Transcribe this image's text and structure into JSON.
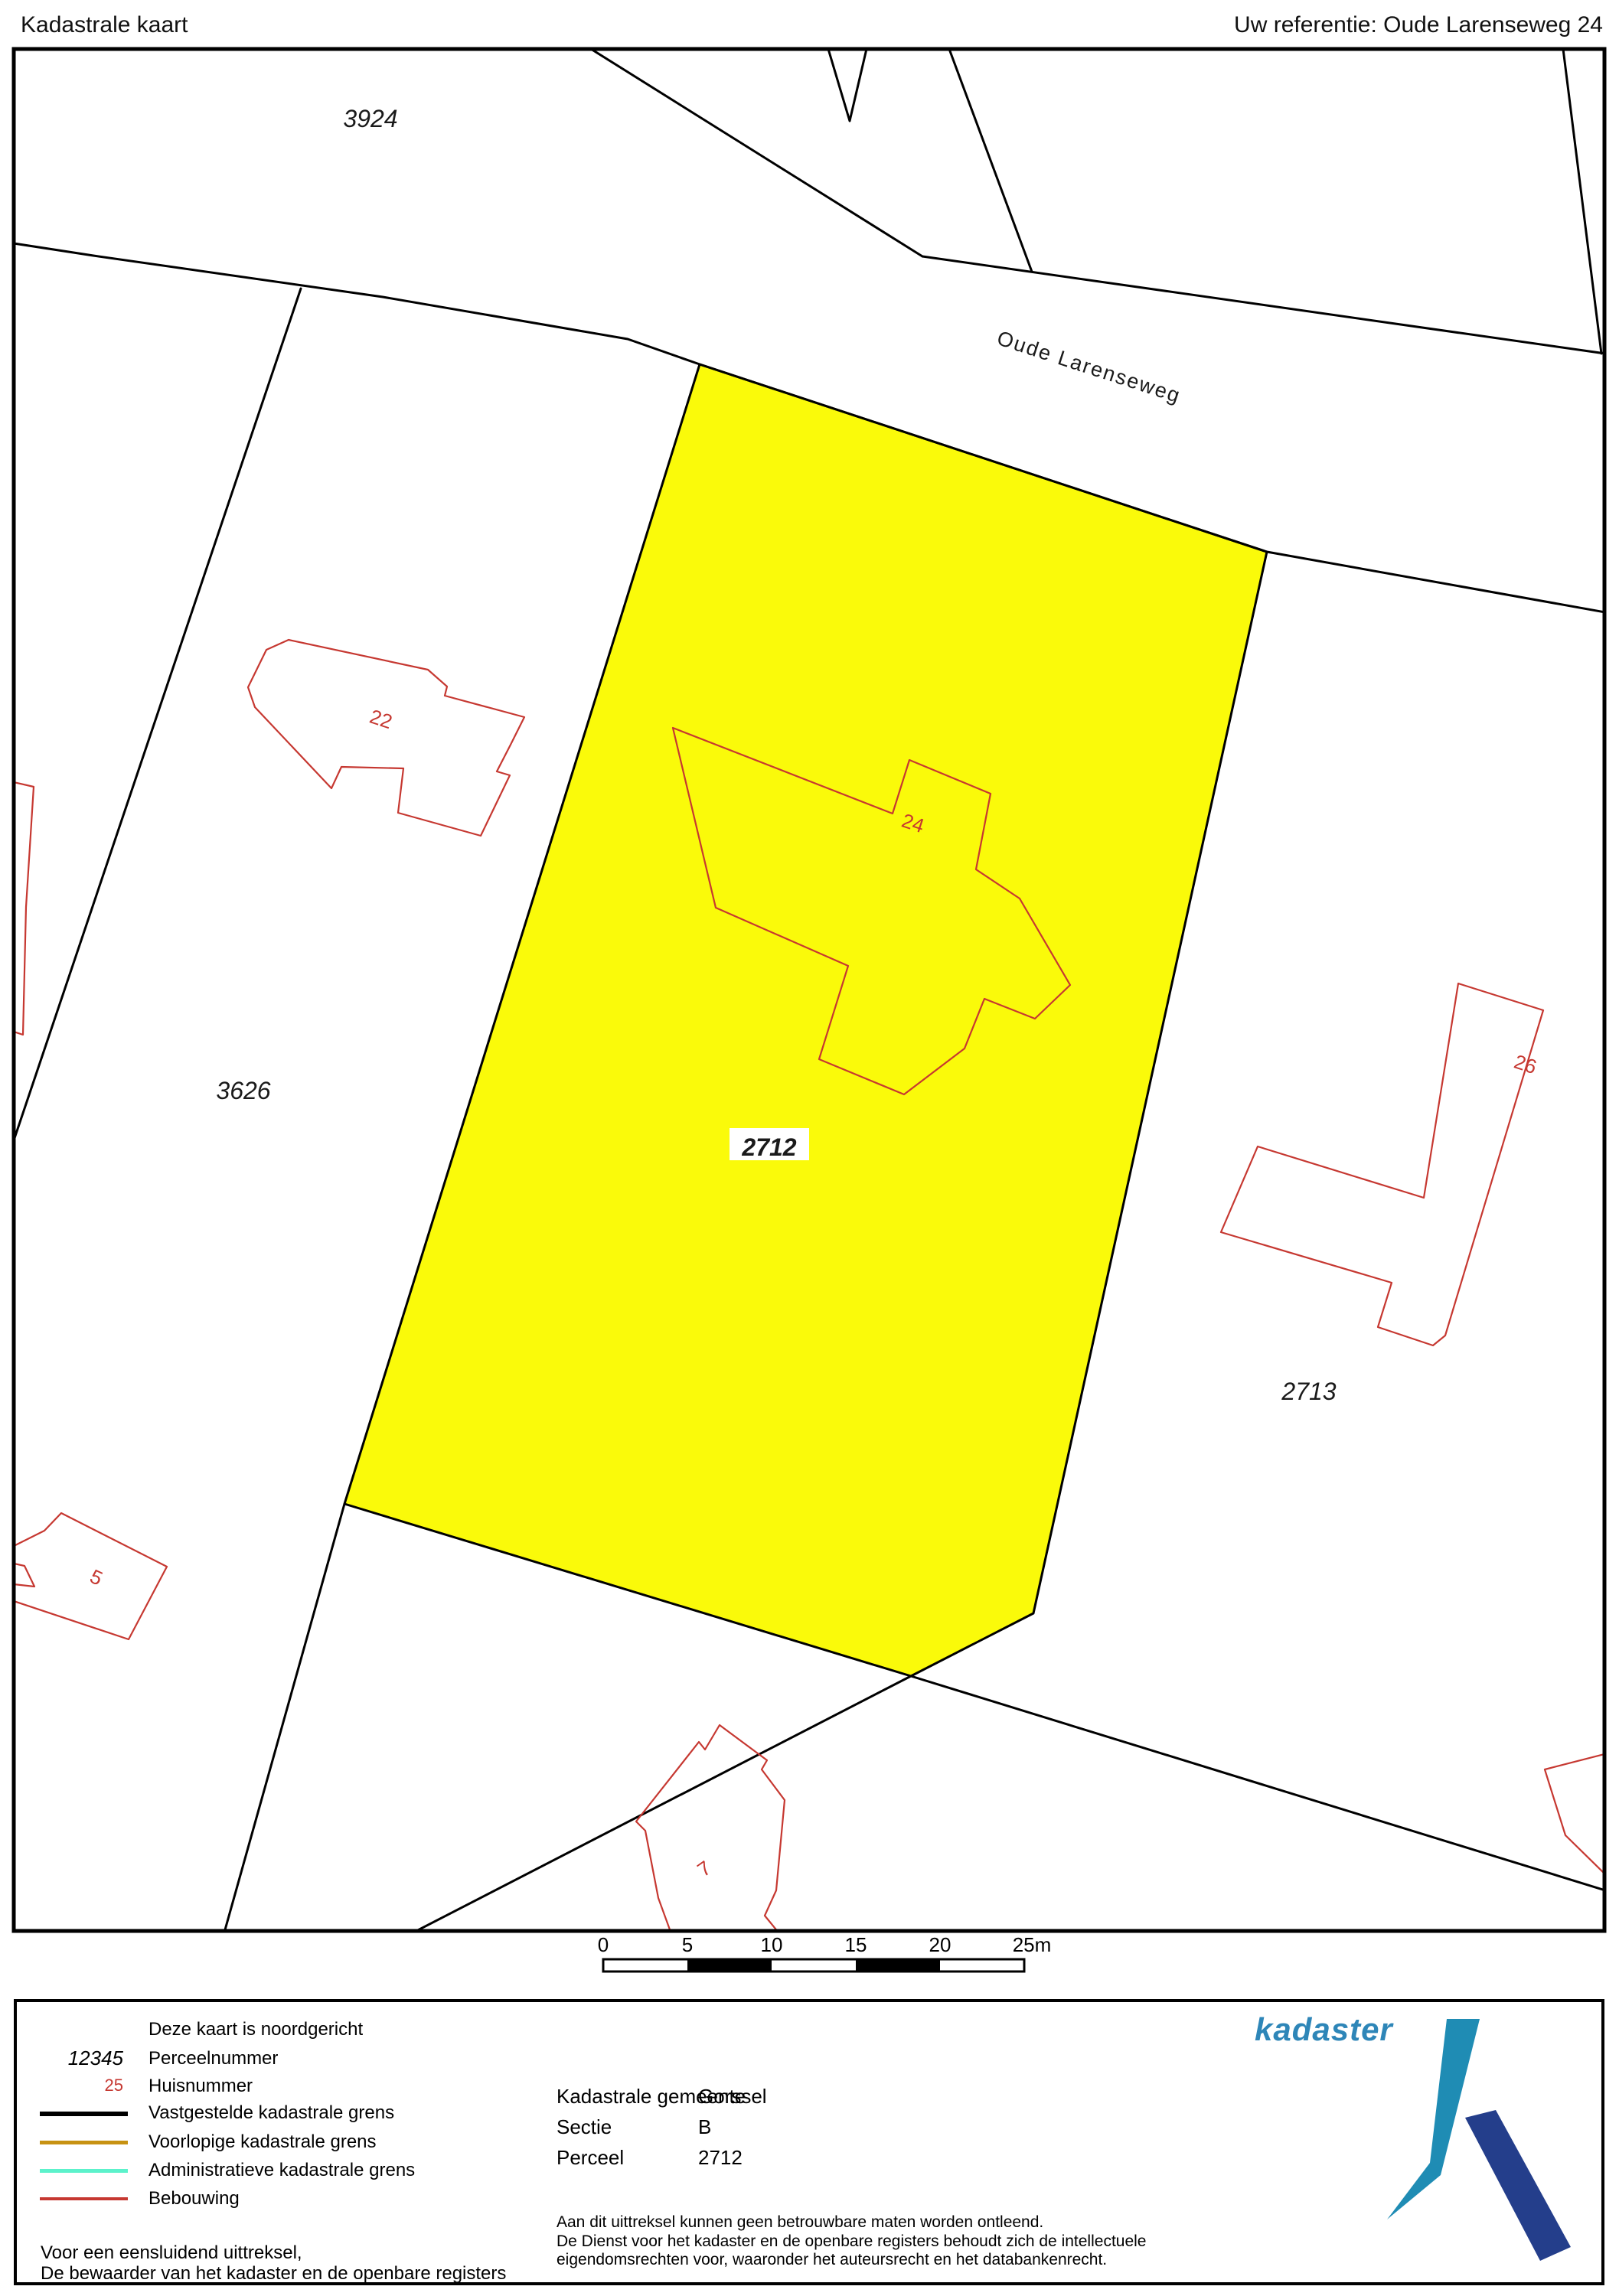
{
  "header": {
    "title": "Kadastrale kaart",
    "reference": "Uw referentie: Oude Larenseweg 24"
  },
  "map": {
    "road_name": "Oude Larenseweg",
    "parcels": [
      {
        "number": "3924"
      },
      {
        "number": "3626"
      },
      {
        "number": "2712",
        "highlighted": true
      },
      {
        "number": "2713"
      }
    ],
    "house_numbers": [
      "22",
      "24",
      "26",
      "5",
      "7"
    ]
  },
  "scalebar": {
    "ticks": [
      "0",
      "5",
      "10",
      "15",
      "20",
      "25m"
    ]
  },
  "legend": {
    "orientation_note": "Deze kaart is noordgericht",
    "items": [
      {
        "sample": "12345",
        "label": "Perceelnummer"
      },
      {
        "sample": "25",
        "label": "Huisnummer"
      },
      {
        "label": "Vastgestelde kadastrale grens"
      },
      {
        "label": "Voorlopige kadastrale grens"
      },
      {
        "label": "Administratieve kadastrale grens"
      },
      {
        "label": "Bebouwing"
      }
    ],
    "attestation": [
      "Voor een eensluidend uittreksel,",
      "De bewaarder van het kadaster en de openbare registers"
    ]
  },
  "info": {
    "rows": [
      {
        "label": "Kadastrale gemeente",
        "value": "Gorssel"
      },
      {
        "label": "Sectie",
        "value": "B"
      },
      {
        "label": "Perceel",
        "value": "2712"
      }
    ],
    "disclaimer": [
      "Aan dit uittreksel kunnen geen betrouwbare maten worden ontleend.",
      "De Dienst voor het kadaster en de openbare registers behoudt zich de intellectuele",
      "eigendomsrechten voor, waaronder het auteursrecht en het databankenrecht."
    ]
  },
  "logo": {
    "text": "kadaster"
  },
  "colors": {
    "parcel_highlight": "#FAFA0A",
    "building": "#C63831",
    "house_number": "#C63831",
    "boundary": "#000000",
    "provisional_boundary": "#C79212",
    "administrative_boundary": "#5CF2CB",
    "logo_text": "#2E86B8",
    "logo_mark_light": "#1F8CB4",
    "logo_mark_dark": "#243E8B"
  }
}
